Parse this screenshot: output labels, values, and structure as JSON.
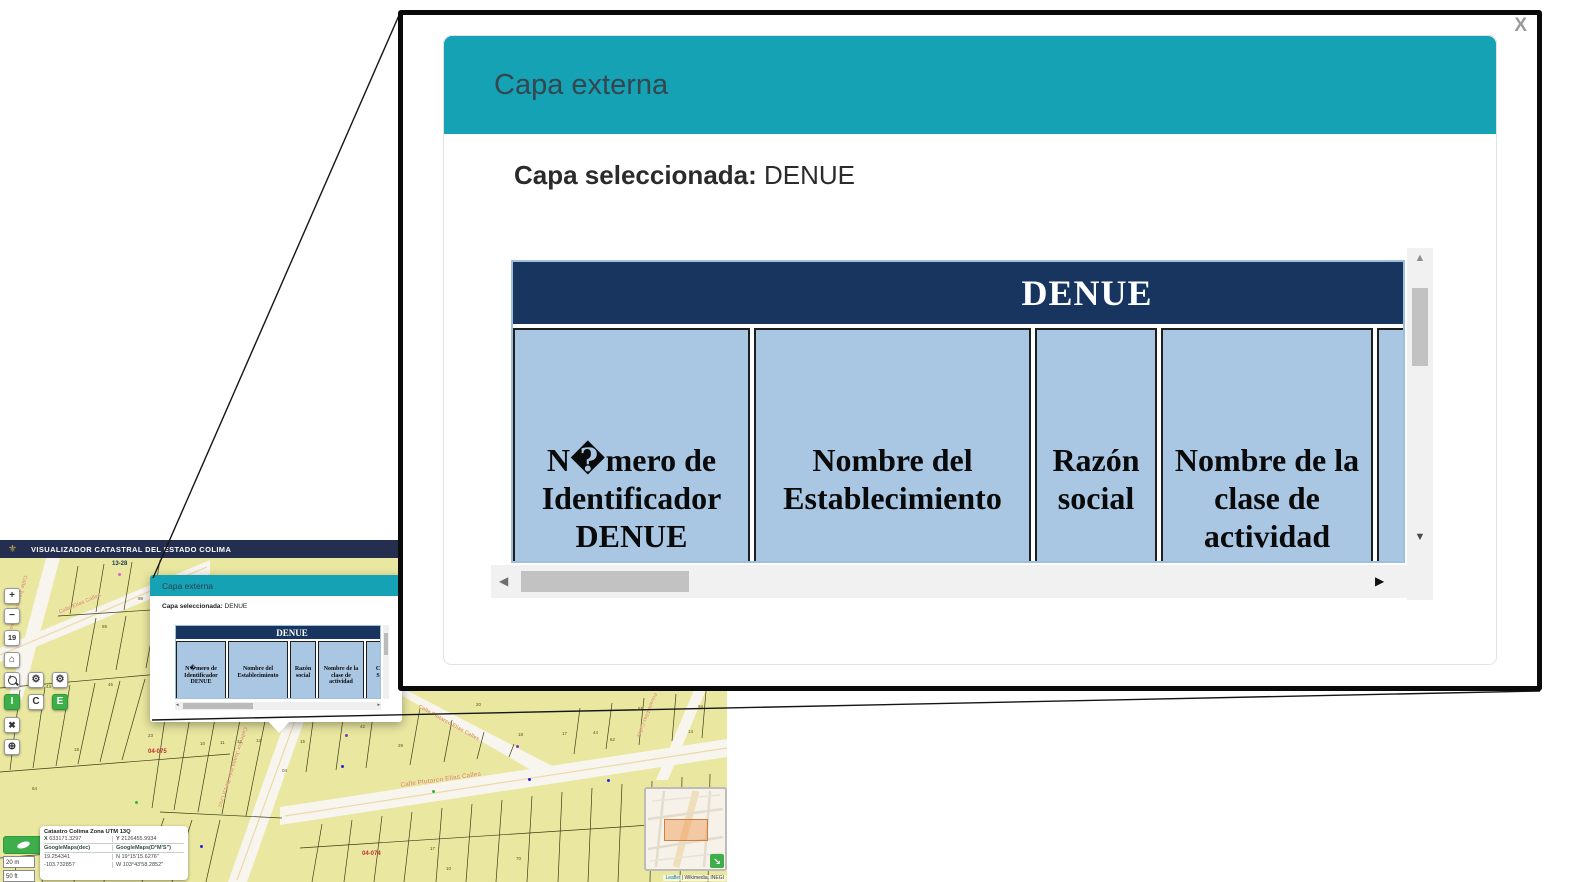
{
  "header": {
    "title": "VISUALIZADOR CATASTRAL DEL ESTADO COLIMA"
  },
  "modal": {
    "title": "Capa externa",
    "selected_label": "Capa seleccionada:",
    "selected_value": "DENUE",
    "table": {
      "title": "DENUE",
      "columns": [
        "N�mero de Identificador DENUE",
        "Nombre del Establecimiento",
        "Razón social",
        "Nombre de la clase de actividad",
        "C\nS"
      ]
    }
  },
  "icons": {
    "close": "X",
    "logo": "⚜",
    "home": "⌂",
    "gear": "⚙",
    "tools": "✖",
    "globe": "⊕",
    "scroll_up": "▲",
    "scroll_down": "▼",
    "scroll_left": "◀",
    "scroll_right": "▶",
    "mini_left": "◂",
    "mini_right": "▸",
    "minimap_toggle": "↘"
  },
  "toolbar": {
    "zoom_in": "+",
    "zoom_out": "−",
    "zoom_level": "19",
    "info": "I",
    "c": "C",
    "e": "E"
  },
  "scale": {
    "metric": "20 m",
    "imperial": "50 ft"
  },
  "coords": {
    "title": "Catastro Colima Zona UTM 13Q",
    "x_label": "X",
    "x_value": "633171.3297",
    "y_label": "Y",
    "y_value": "2126455.9934",
    "dec_label": "GoogleMaps(dec)",
    "dms_label": "GoogleMaps(D°M'S\")",
    "lat_dec": "19.254341",
    "lon_dec": "-103.732857",
    "lat_dms": "N 19°15'15.6276\"",
    "lon_dms": "W 103°43'58.2852\""
  },
  "attribution": {
    "leaflet": "Leaflet",
    "rest": " | Wikimedia, INEGI"
  },
  "colors": {
    "accent_teal": "#14a2b4",
    "table_header_bg": "#17355e",
    "cell_bg": "#a9c6e3",
    "app_header_bg": "#242e4f",
    "parcel_fill": "#e9e7a0",
    "street_fill": "#f8f5ee",
    "street_label": "#d99b5f",
    "zone_red": "#c03030",
    "button_green": "#3dae49"
  },
  "map": {
    "street_labels": [
      {
        "text": "Calle Juventino Rosas",
        "x": 28,
        "y": 18,
        "rot": 105,
        "size": 5.5
      },
      {
        "text": "Calle Elías Calles",
        "x": 58,
        "y": 52,
        "rot": -23,
        "size": 5.5
      },
      {
        "text": "Calle Plutarco Elías Calles",
        "x": 400,
        "y": 224,
        "rot": -8,
        "size": 6.5
      },
      {
        "text": "Calle Plutarco Elías Calles",
        "x": 420,
        "y": 146,
        "rot": 29,
        "size": 5.5
      },
      {
        "text": "Calle Sor Juana Inés De La Cruz",
        "x": 248,
        "y": 170,
        "rot": 108,
        "size": 5.5
      },
      {
        "text": "Privada Elías Calles",
        "x": 658,
        "y": 136,
        "rot": 112,
        "size": 5
      }
    ],
    "zone_labels": [
      {
        "text": "04-075",
        "x": 148,
        "y": 191,
        "color": "#c03030"
      },
      {
        "text": "04-074",
        "x": 362,
        "y": 293,
        "color": "#c03030"
      },
      {
        "text": "13-28",
        "x": 112,
        "y": 3,
        "color": "#223355"
      }
    ],
    "parcel_numbers": [
      {
        "t": "19",
        "x": 12,
        "y": 184
      },
      {
        "t": "18",
        "x": 74,
        "y": 189
      },
      {
        "t": "23",
        "x": 148,
        "y": 175
      },
      {
        "t": "10",
        "x": 200,
        "y": 183
      },
      {
        "t": "11",
        "x": 220,
        "y": 182
      },
      {
        "t": "12",
        "x": 237,
        "y": 181
      },
      {
        "t": "13",
        "x": 256,
        "y": 180
      },
      {
        "t": "15",
        "x": 300,
        "y": 181
      },
      {
        "t": "04",
        "x": 282,
        "y": 210
      },
      {
        "t": "42",
        "x": 360,
        "y": 166
      },
      {
        "t": "29",
        "x": 398,
        "y": 185
      },
      {
        "t": "18",
        "x": 518,
        "y": 174
      },
      {
        "t": "17",
        "x": 562,
        "y": 173
      },
      {
        "t": "44",
        "x": 593,
        "y": 172
      },
      {
        "t": "62",
        "x": 610,
        "y": 179
      },
      {
        "t": "14",
        "x": 688,
        "y": 171
      },
      {
        "t": "16",
        "x": 160,
        "y": 122
      },
      {
        "t": "45",
        "x": 108,
        "y": 124
      },
      {
        "t": "43",
        "x": 46,
        "y": 126
      },
      {
        "t": "89",
        "x": 102,
        "y": 66
      },
      {
        "t": "98",
        "x": 138,
        "y": 38
      },
      {
        "t": "17",
        "x": 430,
        "y": 288
      },
      {
        "t": "70",
        "x": 516,
        "y": 298
      },
      {
        "t": "64",
        "x": 32,
        "y": 228
      },
      {
        "t": "61",
        "x": 638,
        "y": 148
      },
      {
        "t": "94",
        "x": 698,
        "y": 146
      },
      {
        "t": "20",
        "x": 476,
        "y": 144
      },
      {
        "t": "10",
        "x": 446,
        "y": 308
      }
    ],
    "points": [
      {
        "c": "#2626d8",
        "x": 6,
        "y": 159
      },
      {
        "c": "#2626d8",
        "x": 200,
        "y": 287
      },
      {
        "c": "#2626d8",
        "x": 341,
        "y": 207
      },
      {
        "c": "#2626d8",
        "x": 528,
        "y": 220
      },
      {
        "c": "#2626d8",
        "x": 607,
        "y": 221
      },
      {
        "c": "#2db83d",
        "x": 135,
        "y": 243
      },
      {
        "c": "#2db83d",
        "x": 432,
        "y": 232
      },
      {
        "c": "#2db83d",
        "x": 57,
        "y": 114
      },
      {
        "c": "#8833cc",
        "x": 516,
        "y": 187
      },
      {
        "c": "#8833cc",
        "x": 345,
        "y": 176
      },
      {
        "c": "#e060c0",
        "x": 118,
        "y": 15
      }
    ]
  }
}
